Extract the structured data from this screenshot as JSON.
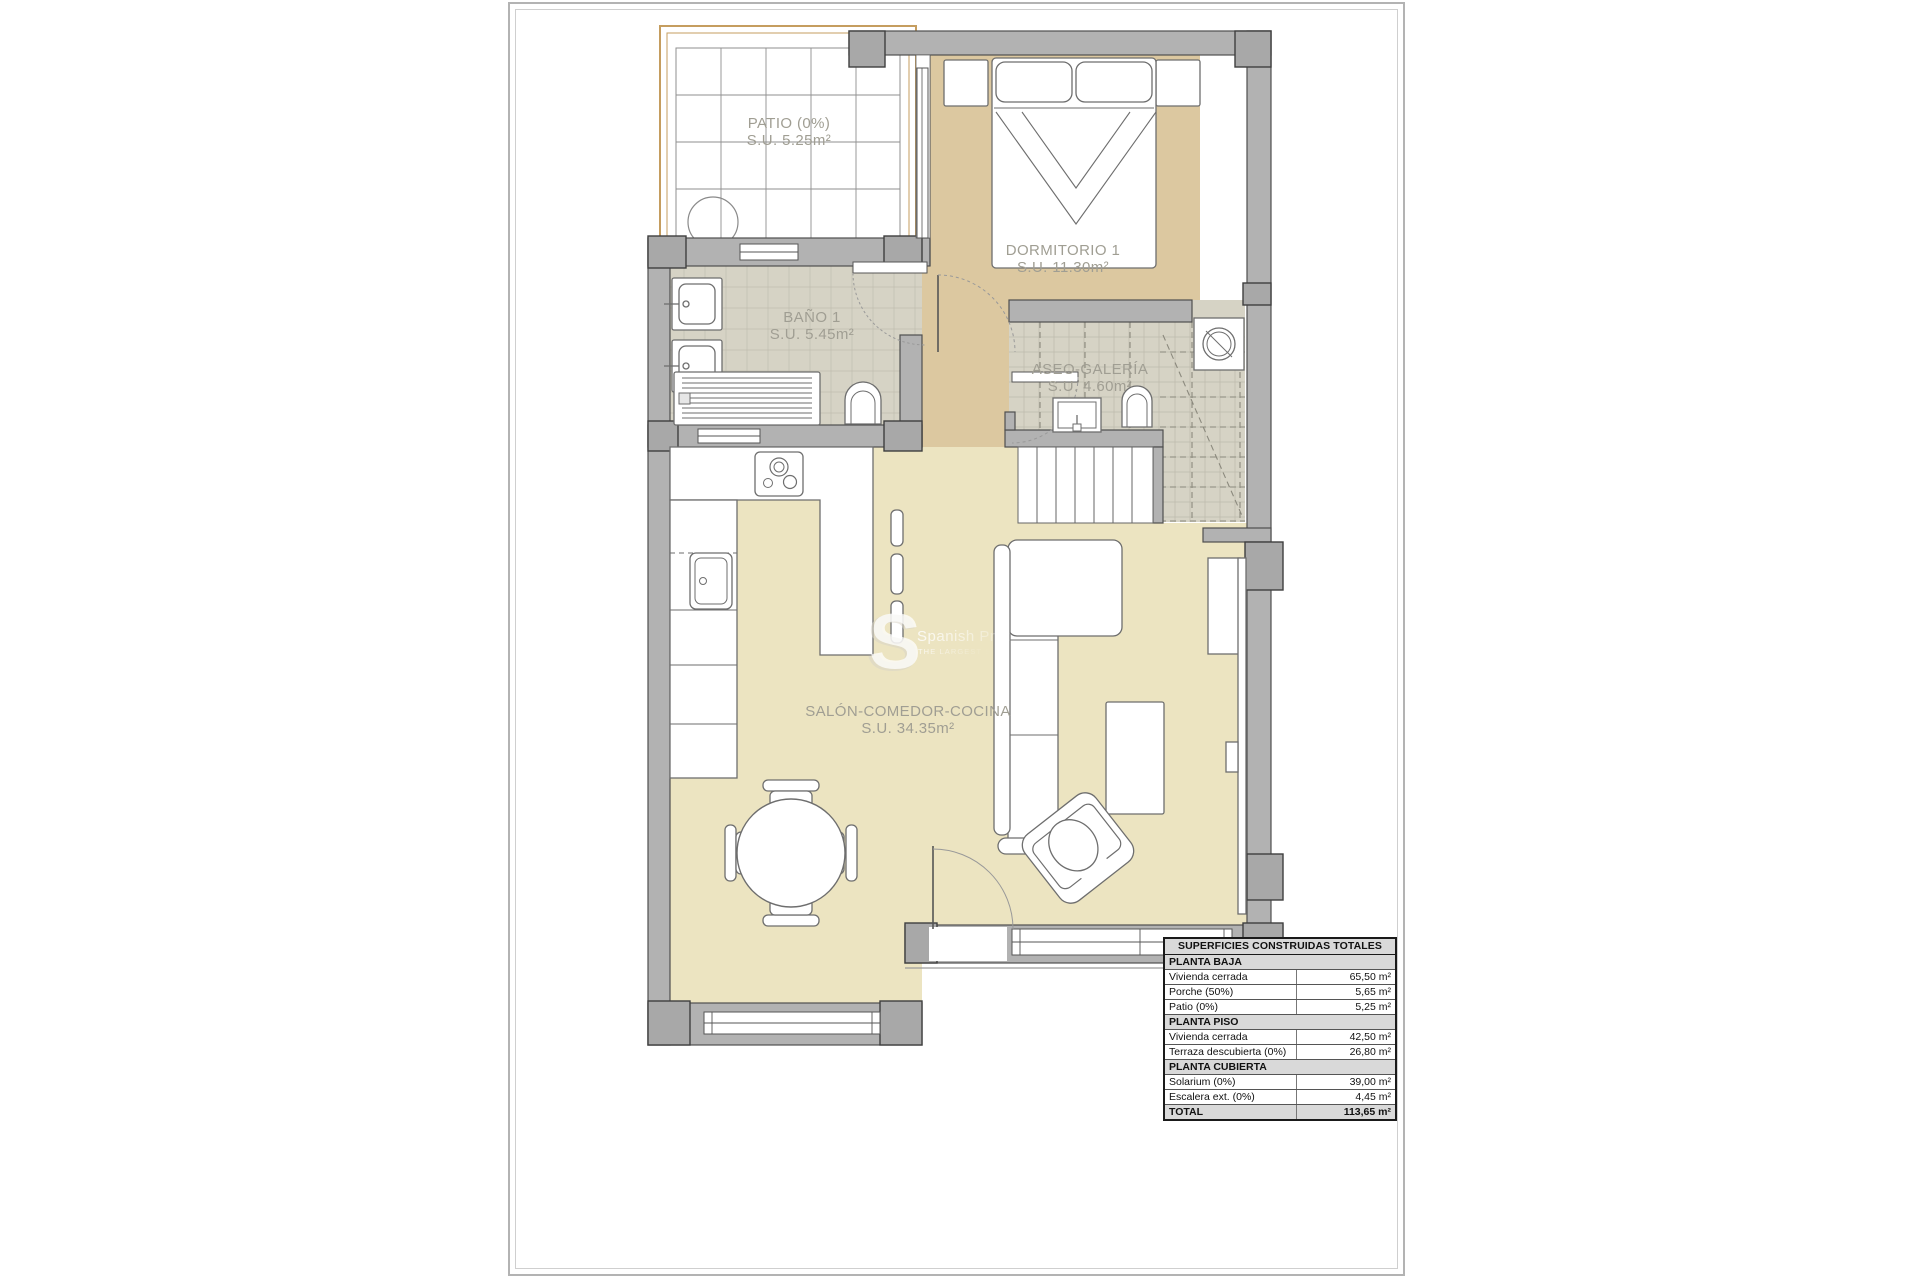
{
  "plan": {
    "rooms": {
      "patio": {
        "name": "PATIO (0%)",
        "area": "S.U. 5.25m²"
      },
      "dormitorio1": {
        "name": "DORMITORIO 1",
        "area": "S.U. 11.30m²"
      },
      "bano1": {
        "name": "BAÑO 1",
        "area": "S.U. 5.45m²"
      },
      "aseo": {
        "name": "ASEO-GALERÍA",
        "area": "S.U. 4.60m²"
      },
      "salon": {
        "name": "SALÓN-COMEDOR-COCINA",
        "area": "S.U. 34.35m²"
      }
    },
    "colors": {
      "wall_gray": "#b2b2b2",
      "pillar_gray": "#a8a8a8",
      "floor_cream": "#ece4c1",
      "floor_tan": "#dcc8a0",
      "tile_gray": "#d6d3c5",
      "patio_border_tan": "#c59d5f",
      "label_gray": "#a09e93"
    }
  },
  "watermark": {
    "logo": "S",
    "line1": "Spanish Prope",
    "line2": "THE LARGEST SPANISH"
  },
  "surfaces_table": {
    "title": "SUPERFICIES CONSTRUIDAS TOTALES",
    "rows": [
      {
        "type": "section",
        "label": "PLANTA BAJA",
        "value": ""
      },
      {
        "type": "data",
        "label": "Vivienda cerrada",
        "value": "65,50 m²"
      },
      {
        "type": "data",
        "label": "Porche (50%)",
        "value": "5,65 m²"
      },
      {
        "type": "data",
        "label": "Patio (0%)",
        "value": "5,25 m²"
      },
      {
        "type": "section",
        "label": "PLANTA PISO",
        "value": ""
      },
      {
        "type": "data",
        "label": "Vivienda cerrada",
        "value": "42,50 m²"
      },
      {
        "type": "data",
        "label": "Terraza descubierta (0%)",
        "value": "26,80 m²"
      },
      {
        "type": "section",
        "label": "PLANTA CUBIERTA",
        "value": ""
      },
      {
        "type": "data",
        "label": "Solarium (0%)",
        "value": "39,00 m²"
      },
      {
        "type": "data",
        "label": "Escalera ext. (0%)",
        "value": "4,45 m²"
      },
      {
        "type": "total",
        "label": "TOTAL",
        "value": "113,65 m²"
      }
    ]
  }
}
